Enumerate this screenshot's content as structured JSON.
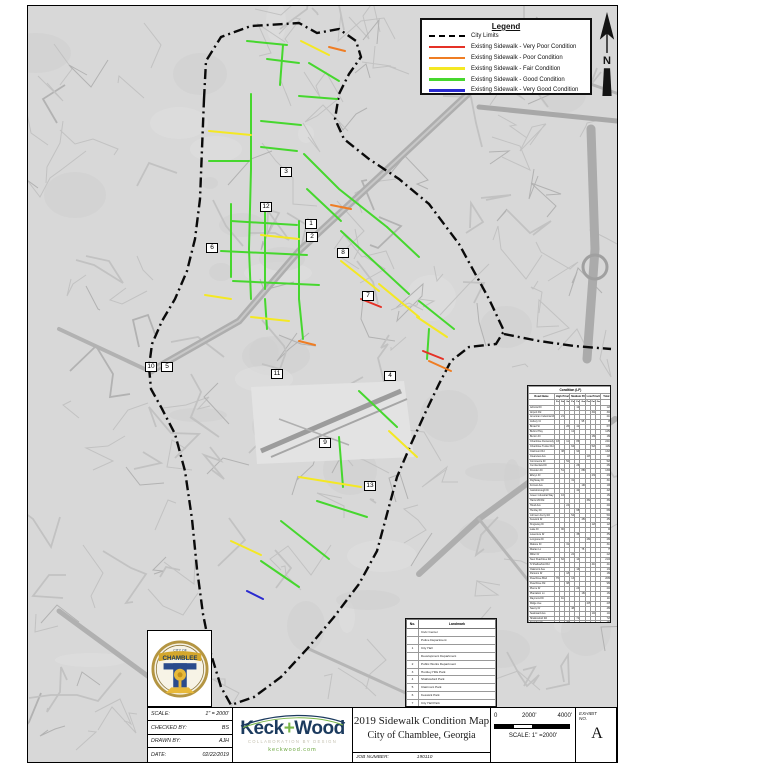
{
  "legend": {
    "title": "Legend",
    "items": [
      {
        "label": "City Limits",
        "style": "dashed",
        "color": "#000000"
      },
      {
        "label": "Existing Sidewalk - Very Poor Condition",
        "style": "line",
        "color": "#e53126"
      },
      {
        "label": "Existing Sidewalk - Poor Condition",
        "style": "line",
        "color": "#ef7d23"
      },
      {
        "label": "Existing Sidewalk - Fair Condition",
        "style": "line",
        "color": "#f4e823"
      },
      {
        "label": "Existing Sidewalk - Good Condition",
        "style": "line",
        "color": "#46d72e"
      },
      {
        "label": "Existing Sidewalk - Very Good Condition",
        "style": "line",
        "color": "#2a2ad0"
      }
    ]
  },
  "north_arrow": {
    "label": "N"
  },
  "markers": [
    {
      "label": "3",
      "x": 286,
      "y": 172
    },
    {
      "label": "12",
      "x": 266,
      "y": 207
    },
    {
      "label": "1",
      "x": 311,
      "y": 224
    },
    {
      "label": "2",
      "x": 312,
      "y": 237
    },
    {
      "label": "8",
      "x": 343,
      "y": 253
    },
    {
      "label": "6",
      "x": 212,
      "y": 248
    },
    {
      "label": "7",
      "x": 368,
      "y": 296
    },
    {
      "label": "4",
      "x": 390,
      "y": 376
    },
    {
      "label": "10",
      "x": 151,
      "y": 367
    },
    {
      "label": "5",
      "x": 167,
      "y": 367
    },
    {
      "label": "11",
      "x": 277,
      "y": 374
    },
    {
      "label": "9",
      "x": 325,
      "y": 443
    },
    {
      "label": "13",
      "x": 370,
      "y": 486
    }
  ],
  "condition_table": {
    "title": "Condition (LF)",
    "first_column": "Road Name",
    "col_groups": [
      "High Priority",
      "Medium Priority",
      "Low Priority"
    ],
    "sub_columns": [
      "Poor",
      "Fair",
      "Good"
    ],
    "last_column": "Total",
    "rows": [
      [
        "Admiral Dr",
        "",
        "",
        "",
        "",
        "120",
        "",
        "",
        "",
        "",
        "120"
      ],
      [
        "Airport Rd",
        "",
        "",
        "",
        "",
        "",
        "",
        "",
        "340",
        "",
        "340"
      ],
      [
        "American Industrial Way",
        "",
        "210",
        "",
        "",
        "",
        "",
        "",
        "",
        "",
        "210"
      ],
      [
        "Asbury Ct",
        "",
        "",
        "",
        "",
        "",
        "95",
        "",
        "",
        "",
        "95"
      ],
      [
        "Broad St",
        "",
        "",
        "260",
        "",
        "410",
        "",
        "",
        "",
        "",
        "670"
      ],
      [
        "Buford Hwy",
        "",
        "",
        "",
        "1250",
        "",
        "",
        "",
        "",
        "",
        "1250"
      ],
      [
        "Burton Dr",
        "",
        "",
        "",
        "",
        "",
        "",
        "",
        "180",
        "",
        "180"
      ],
      [
        "Chamblee Dunwoody Rd",
        "430",
        "",
        "1120",
        "",
        "860",
        "",
        "",
        "",
        "",
        "2410"
      ],
      [
        "Chamblee Tucker Rd",
        "",
        "",
        "",
        "640",
        "",
        "",
        "",
        "520",
        "",
        "1160"
      ],
      [
        "Clairmont Rd",
        "",
        "380",
        "",
        "",
        "940",
        "",
        "",
        "",
        "",
        "1320"
      ],
      [
        "Clearview Ave",
        "",
        "",
        "",
        "",
        "",
        "",
        "145",
        "",
        "",
        "145"
      ],
      [
        "Commerce Dr",
        "",
        "",
        "520",
        "",
        "",
        "",
        "",
        "",
        "",
        "520"
      ],
      [
        "Cumberland Dr",
        "",
        "",
        "",
        "",
        "260",
        "",
        "",
        "",
        "",
        "260"
      ],
      [
        "Dresden Dr",
        "",
        "510",
        "",
        "",
        "",
        "880",
        "",
        "",
        "",
        "1390"
      ],
      [
        "Ellwyn Dr",
        "",
        "",
        "",
        "",
        "",
        "",
        "",
        "230",
        "",
        "230"
      ],
      [
        "Flightway Dr",
        "",
        "",
        "",
        "310",
        "",
        "",
        "",
        "",
        "",
        "310"
      ],
      [
        "Forrest Ave",
        "",
        "",
        "",
        "",
        "",
        "190",
        "",
        "",
        "",
        "190"
      ],
      [
        "Gainsborough Dr",
        "",
        "",
        "",
        "",
        "420",
        "",
        "",
        "",
        "",
        "420"
      ],
      [
        "Green Industrial Way",
        "",
        "160",
        "",
        "",
        "",
        "",
        "",
        "",
        "",
        "160"
      ],
      [
        "Harts Mill Rd",
        "",
        "",
        "",
        "",
        "",
        "",
        "360",
        "",
        "",
        "360"
      ],
      [
        "Hood Ave",
        "",
        "",
        "240",
        "",
        "",
        "",
        "",
        "",
        "",
        "240"
      ],
      [
        "Huntley Dr",
        "",
        "",
        "",
        "",
        "680",
        "",
        "",
        "",
        "",
        "680"
      ],
      [
        "Johnson Ferry Rd",
        "",
        "",
        "",
        "540",
        "",
        "",
        "",
        "",
        "",
        "540"
      ],
      [
        "Keswick Dr",
        "",
        "",
        "",
        "",
        "",
        "450",
        "",
        "",
        "",
        "450"
      ],
      [
        "Kingsway Dr",
        "",
        "",
        "",
        "",
        "",
        "",
        "",
        "120",
        "",
        "120"
      ],
      [
        "Lake Dr",
        "",
        "90",
        "",
        "",
        "",
        "",
        "",
        "",
        "",
        "90"
      ],
      [
        "Laventure Dr",
        "",
        "",
        "",
        "",
        "350",
        "",
        "",
        "",
        "",
        "350"
      ],
      [
        "Longview Dr",
        "",
        "",
        "",
        "",
        "",
        "",
        "280",
        "",
        "",
        "280"
      ],
      [
        "Malone Dr",
        "",
        "",
        "310",
        "",
        "",
        "",
        "",
        "",
        "",
        "310"
      ],
      [
        "Marian Ln",
        "",
        "",
        "",
        "",
        "",
        "75",
        "",
        "",
        "",
        "75"
      ],
      [
        "Miller Dr",
        "",
        "",
        "",
        "220",
        "",
        "",
        "",
        "",
        "",
        "220"
      ],
      [
        "New Peachtree Rd",
        "",
        "620",
        "",
        "",
        "1480",
        "",
        "",
        "",
        "",
        "2100"
      ],
      [
        "N Shallowford Rd",
        "",
        "",
        "",
        "",
        "",
        "",
        "",
        "410",
        "",
        "410"
      ],
      [
        "Oakmont Ave",
        "",
        "",
        "",
        "",
        "130",
        "",
        "",
        "",
        "",
        "130"
      ],
      [
        "Parsons Dr",
        "",
        "",
        "180",
        "",
        "",
        "",
        "",
        "",
        "",
        "180"
      ],
      [
        "Peachtree Blvd",
        "760",
        "",
        "",
        "1320",
        "",
        "",
        "",
        "",
        "",
        "2080"
      ],
      [
        "Peachtree Rd",
        "",
        "",
        "980",
        "",
        "",
        "",
        "",
        "",
        "",
        "980"
      ],
      [
        "Pierce Dr",
        "",
        "",
        "",
        "",
        "240",
        "",
        "",
        "",
        "",
        "240"
      ],
      [
        "Plantation Ln",
        "",
        "",
        "",
        "",
        "",
        "160",
        "",
        "",
        "",
        "160"
      ],
      [
        "Raymond Dr",
        "",
        "110",
        "",
        "",
        "",
        "",
        "",
        "",
        "",
        "110"
      ],
      [
        "Ridge Ave",
        "",
        "",
        "",
        "",
        "",
        "",
        "205",
        "",
        "",
        "205"
      ],
      [
        "Savoy Dr",
        "",
        "",
        "",
        "480",
        "",
        "",
        "",
        "",
        "",
        "480"
      ],
      [
        "Seaboard Ave",
        "",
        "",
        "",
        "",
        "",
        "",
        "",
        "140",
        "",
        "140"
      ],
      [
        "Shallowford Rd",
        "",
        "",
        "",
        "",
        "720",
        "",
        "",
        "",
        "",
        "720"
      ],
      [
        "Spalding Dr",
        "",
        "",
        "260",
        "",
        "",
        "",
        "",
        "",
        "",
        "260"
      ],
      [
        "Tilly Mill Rd",
        "",
        "",
        "",
        "",
        "",
        "330",
        "",
        "",
        "",
        "330"
      ],
      [
        "Vantage Point Pkwy",
        "",
        "",
        "",
        "170",
        "",
        "",
        "",
        "",
        "",
        "170"
      ],
      [
        "Walker Dr",
        "",
        "85",
        "",
        "",
        "",
        "",
        "",
        "",
        "",
        "85"
      ],
      [
        "Watkins Ave",
        "",
        "",
        "",
        "",
        "290",
        "",
        "",
        "",
        "",
        "290"
      ],
      [
        "Wendover Dr",
        "",
        "",
        "",
        "",
        "",
        "",
        "150",
        "",
        "",
        "150"
      ],
      [
        "Whitehall Way",
        "",
        "",
        "",
        "",
        "",
        "95",
        "",
        "",
        "",
        "95"
      ],
      [
        "Wilson Dr",
        "",
        "",
        "200",
        "",
        "",
        "",
        "",
        "",
        "",
        "200"
      ],
      [
        "Windsor Ct",
        "",
        "",
        "",
        "",
        "60",
        "",
        "",
        "",
        "",
        "60"
      ],
      [
        "Woodland Ave",
        "",
        "",
        "",
        "",
        "",
        "",
        "",
        "175",
        "",
        "175"
      ],
      [
        "Total",
        "1190",
        "2165",
        "4070",
        "4930",
        "6960",
        "2275",
        "1140",
        "2115",
        "",
        "24845"
      ]
    ]
  },
  "landmark_table": {
    "headers": [
      "No.",
      "Landmark"
    ],
    "rows": [
      [
        "",
        "Civic Center"
      ],
      [
        "",
        "Police Department"
      ],
      [
        "1",
        "City Hall"
      ],
      [
        "",
        "Development Department"
      ],
      [
        "2",
        "Public Works Department"
      ],
      [
        "3",
        "Huntley Hills Park"
      ],
      [
        "4",
        "Shallowford Park"
      ],
      [
        "5",
        "Clairmont Park"
      ],
      [
        "6",
        "Keswick Park"
      ],
      [
        "7",
        "City Hall Park"
      ],
      [
        "8",
        "Village Park"
      ],
      [
        "9",
        "Dresden Park"
      ],
      [
        "10",
        "Central Park"
      ],
      [
        "11",
        "DeKalb - Peachtree Airport"
      ],
      [
        "12",
        "Chamblee Charter High School"
      ],
      [
        "13",
        "St. Pius X Catholic High School"
      ]
    ]
  },
  "city_seal": {
    "city_of": "CITY OF",
    "name": "CHAMBLEE"
  },
  "title_block": {
    "fields": [
      {
        "label": "SCALE:",
        "value": "1\" = 2000'"
      },
      {
        "label": "CHECKED BY:",
        "value": "BS"
      },
      {
        "label": "DRAWN BY:",
        "value": "AJH"
      },
      {
        "label": "DATE:",
        "value": "02/22/2019"
      }
    ],
    "company": {
      "part1": "Keck",
      "plus": "+",
      "part2": "Wood",
      "tagline": "COLLABORATION BY DESIGN",
      "website": "keckwood.com",
      "navy": "#1b3a5e",
      "green": "#7ab648"
    },
    "title_line1": "2019 Sidewalk Condition Map",
    "title_line2": "City of Chamblee, Georgia",
    "job_number_label": "JOB NUMBER:",
    "job_number": "190110",
    "scale_bar": {
      "labels": [
        "0",
        "2000'",
        "4000'"
      ],
      "caption": "SCALE: 1\" =2000'"
    },
    "exhibit": {
      "label": "EXHIBIT NO.",
      "value": "A"
    }
  }
}
